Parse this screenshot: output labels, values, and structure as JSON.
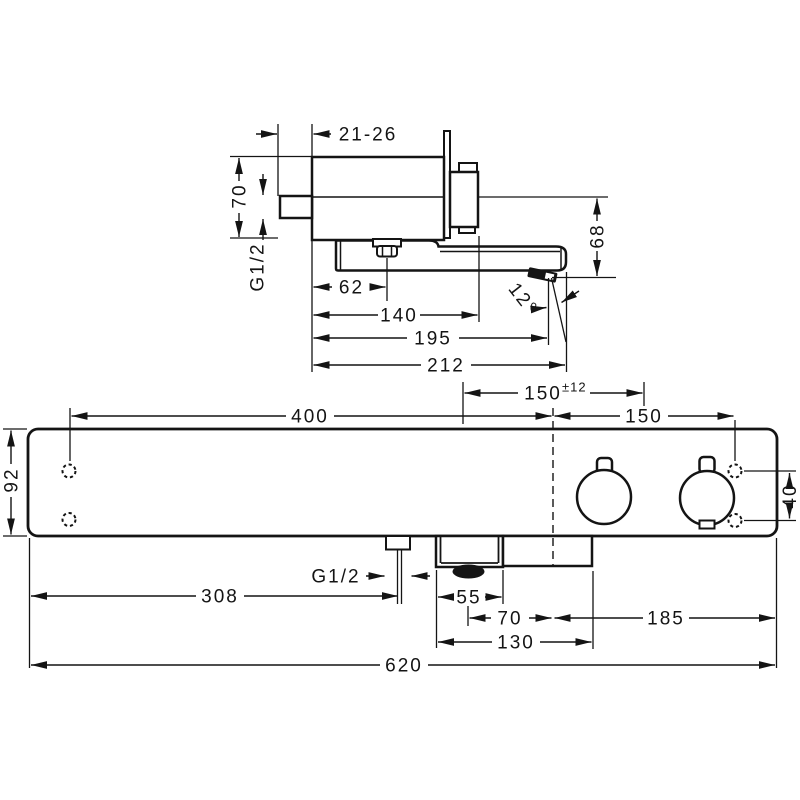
{
  "colors": {
    "line": "#141414",
    "background": "#ffffff"
  },
  "side_view": {
    "dims": {
      "wall_depth": "21-26",
      "body_height": "70",
      "thread": "G1/2",
      "nut_offset": "62",
      "handle_depth": "140",
      "outlet_depth": "195",
      "spout_length": "212",
      "outlet_drop": "68",
      "spout_angle": "12°"
    }
  },
  "front_view": {
    "dims": {
      "left_to_center": "400",
      "supply_spacing": "150",
      "supply_tolerance": "±12",
      "center_to_fixing": "150",
      "body_height": "92",
      "fixing_spacing": "40",
      "thread": "G1/2",
      "left_to_outlet": "308",
      "outlet_width": "55",
      "outlet_to_center": "70",
      "outlet_unit_width": "130",
      "center_to_right_edge": "185",
      "total_width": "620"
    }
  }
}
